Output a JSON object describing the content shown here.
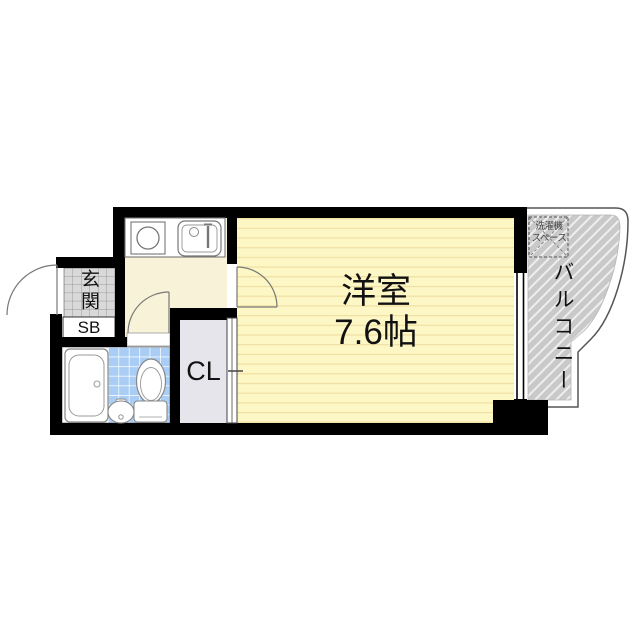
{
  "floorplan": {
    "main_room": {
      "name": "洋室",
      "size": "7.6帖"
    },
    "entrance": {
      "label": "玄関"
    },
    "shoe_box": {
      "label": "SB"
    },
    "closet": {
      "label": "CL"
    },
    "balcony": {
      "label": "バルコニー"
    },
    "laundry_space": {
      "line1": "洗濯機",
      "line2": "スペース"
    },
    "colors": {
      "wall": "#000000",
      "main_room_fill": "#fdf7c6",
      "main_room_stripe": "#f0dfa2",
      "hallway_fill": "#f8f3d8",
      "bathroom_tile": "#a9cdf4",
      "entrance_tile": "#d9d9d9",
      "closet_fill": "#e7e5ec",
      "balcony_fill": "#c9c9c9",
      "fixture_outline": "#808080"
    }
  }
}
